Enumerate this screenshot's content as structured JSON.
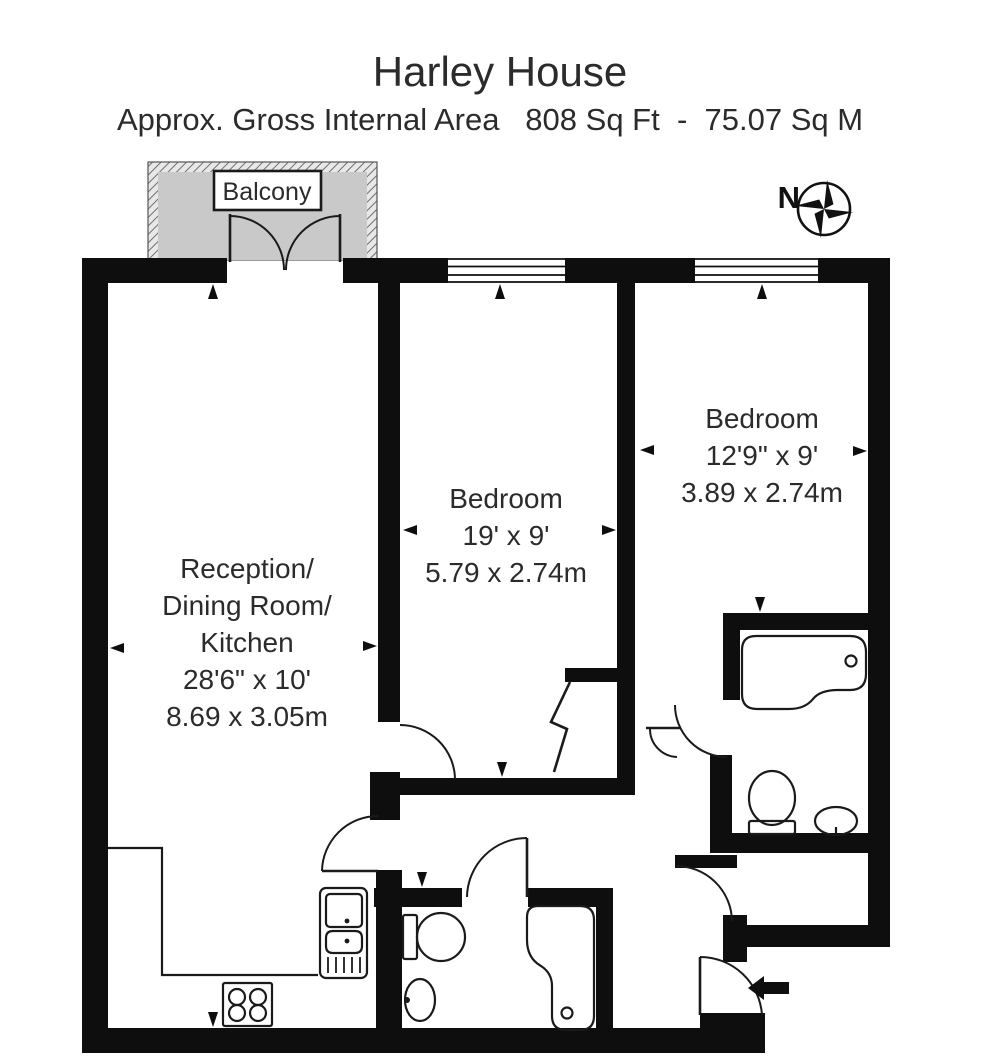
{
  "header": {
    "title": "Harley House",
    "subtitle": "Approx. Gross Internal Area   808 Sq Ft  -  75.07 Sq M"
  },
  "plan": {
    "balcony_label": "Balcony",
    "compass_label": "N",
    "rooms": [
      {
        "id": "reception-dining-kitchen",
        "lines": [
          "Reception/",
          "Dining Room/",
          "Kitchen",
          "28'6\" x 10'",
          "8.69 x 3.05m"
        ]
      },
      {
        "id": "bedroom-middle",
        "lines": [
          "Bedroom",
          "19' x 9'",
          "5.79 x 2.74m"
        ]
      },
      {
        "id": "bedroom-right",
        "lines": [
          "Bedroom",
          "12'9\" x 9'",
          "3.89 x 2.74m"
        ]
      }
    ]
  },
  "colors": {
    "wall": "#0e0e0e",
    "balcony_fill": "#c9c9c9",
    "text": "#2b2b2b"
  }
}
